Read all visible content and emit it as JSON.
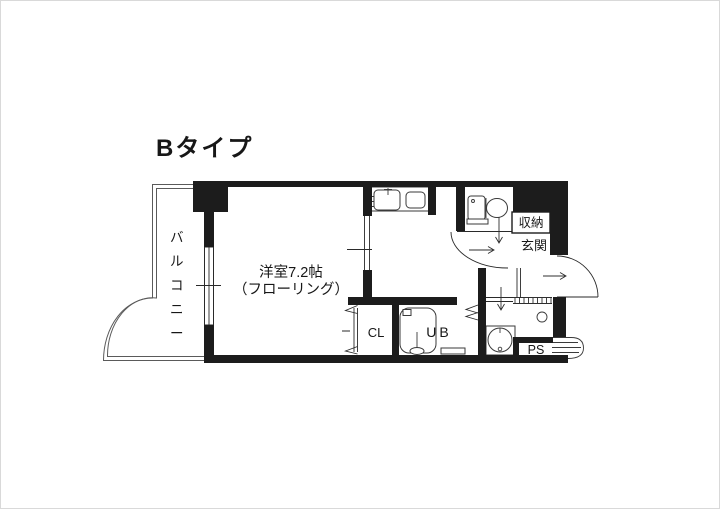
{
  "page": {
    "background": "#ffffff",
    "border_color": "#d9d9d9"
  },
  "plan": {
    "title": "Bタイプ",
    "colors": {
      "wall": "#1c1c1c",
      "line": "#2a2a2a",
      "balcony_line": "#5a5a5a",
      "text": "#171717"
    },
    "rooms": {
      "balcony": {
        "label": "バルコニー"
      },
      "main_room": {
        "label_line1": "洋室7.2帖",
        "label_line2": "（フローリング）"
      },
      "closet": {
        "label": "CL"
      },
      "unit_bath": {
        "label": "UB"
      },
      "storage": {
        "label": "収納"
      },
      "entrance": {
        "label": "玄関"
      },
      "pipe_space": {
        "label": "PS"
      }
    }
  }
}
